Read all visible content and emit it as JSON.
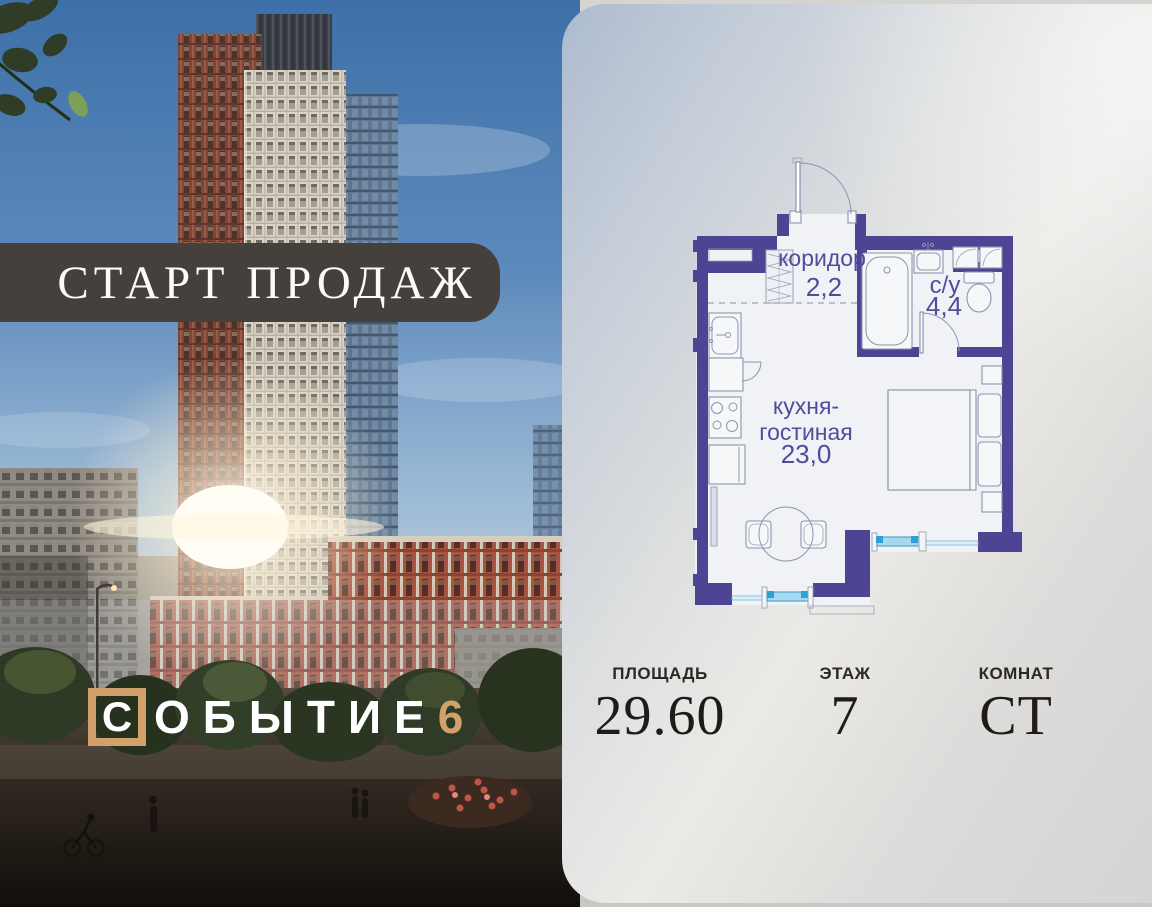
{
  "banner": {
    "label": "СТАРТ ПРОДАЖ"
  },
  "logo": {
    "boxed_letter": "С",
    "letters": "ОБЫТИЕ",
    "number": "6"
  },
  "floor_plan": {
    "rooms": {
      "corridor": {
        "name": "коридор",
        "area": "2,2"
      },
      "bathroom": {
        "name": "с/у",
        "area": "4,4"
      },
      "kitchen_living": {
        "name_line1": "кухня-",
        "name_line2": "гостиная",
        "area": "23,0"
      }
    }
  },
  "stats": {
    "area": {
      "label": "ПЛОЩАДЬ",
      "value": "29.60"
    },
    "floor": {
      "label": "ЭТАЖ",
      "value": "7"
    },
    "rooms": {
      "label": "КОМНАТ",
      "value": "СТ"
    }
  },
  "colors": {
    "wall": "#4e4494",
    "room_label": "#4c4e9b",
    "accent_tan": "#d2a06b",
    "banner_bg": "#45403c",
    "window_blue": "#a6d9ef"
  }
}
